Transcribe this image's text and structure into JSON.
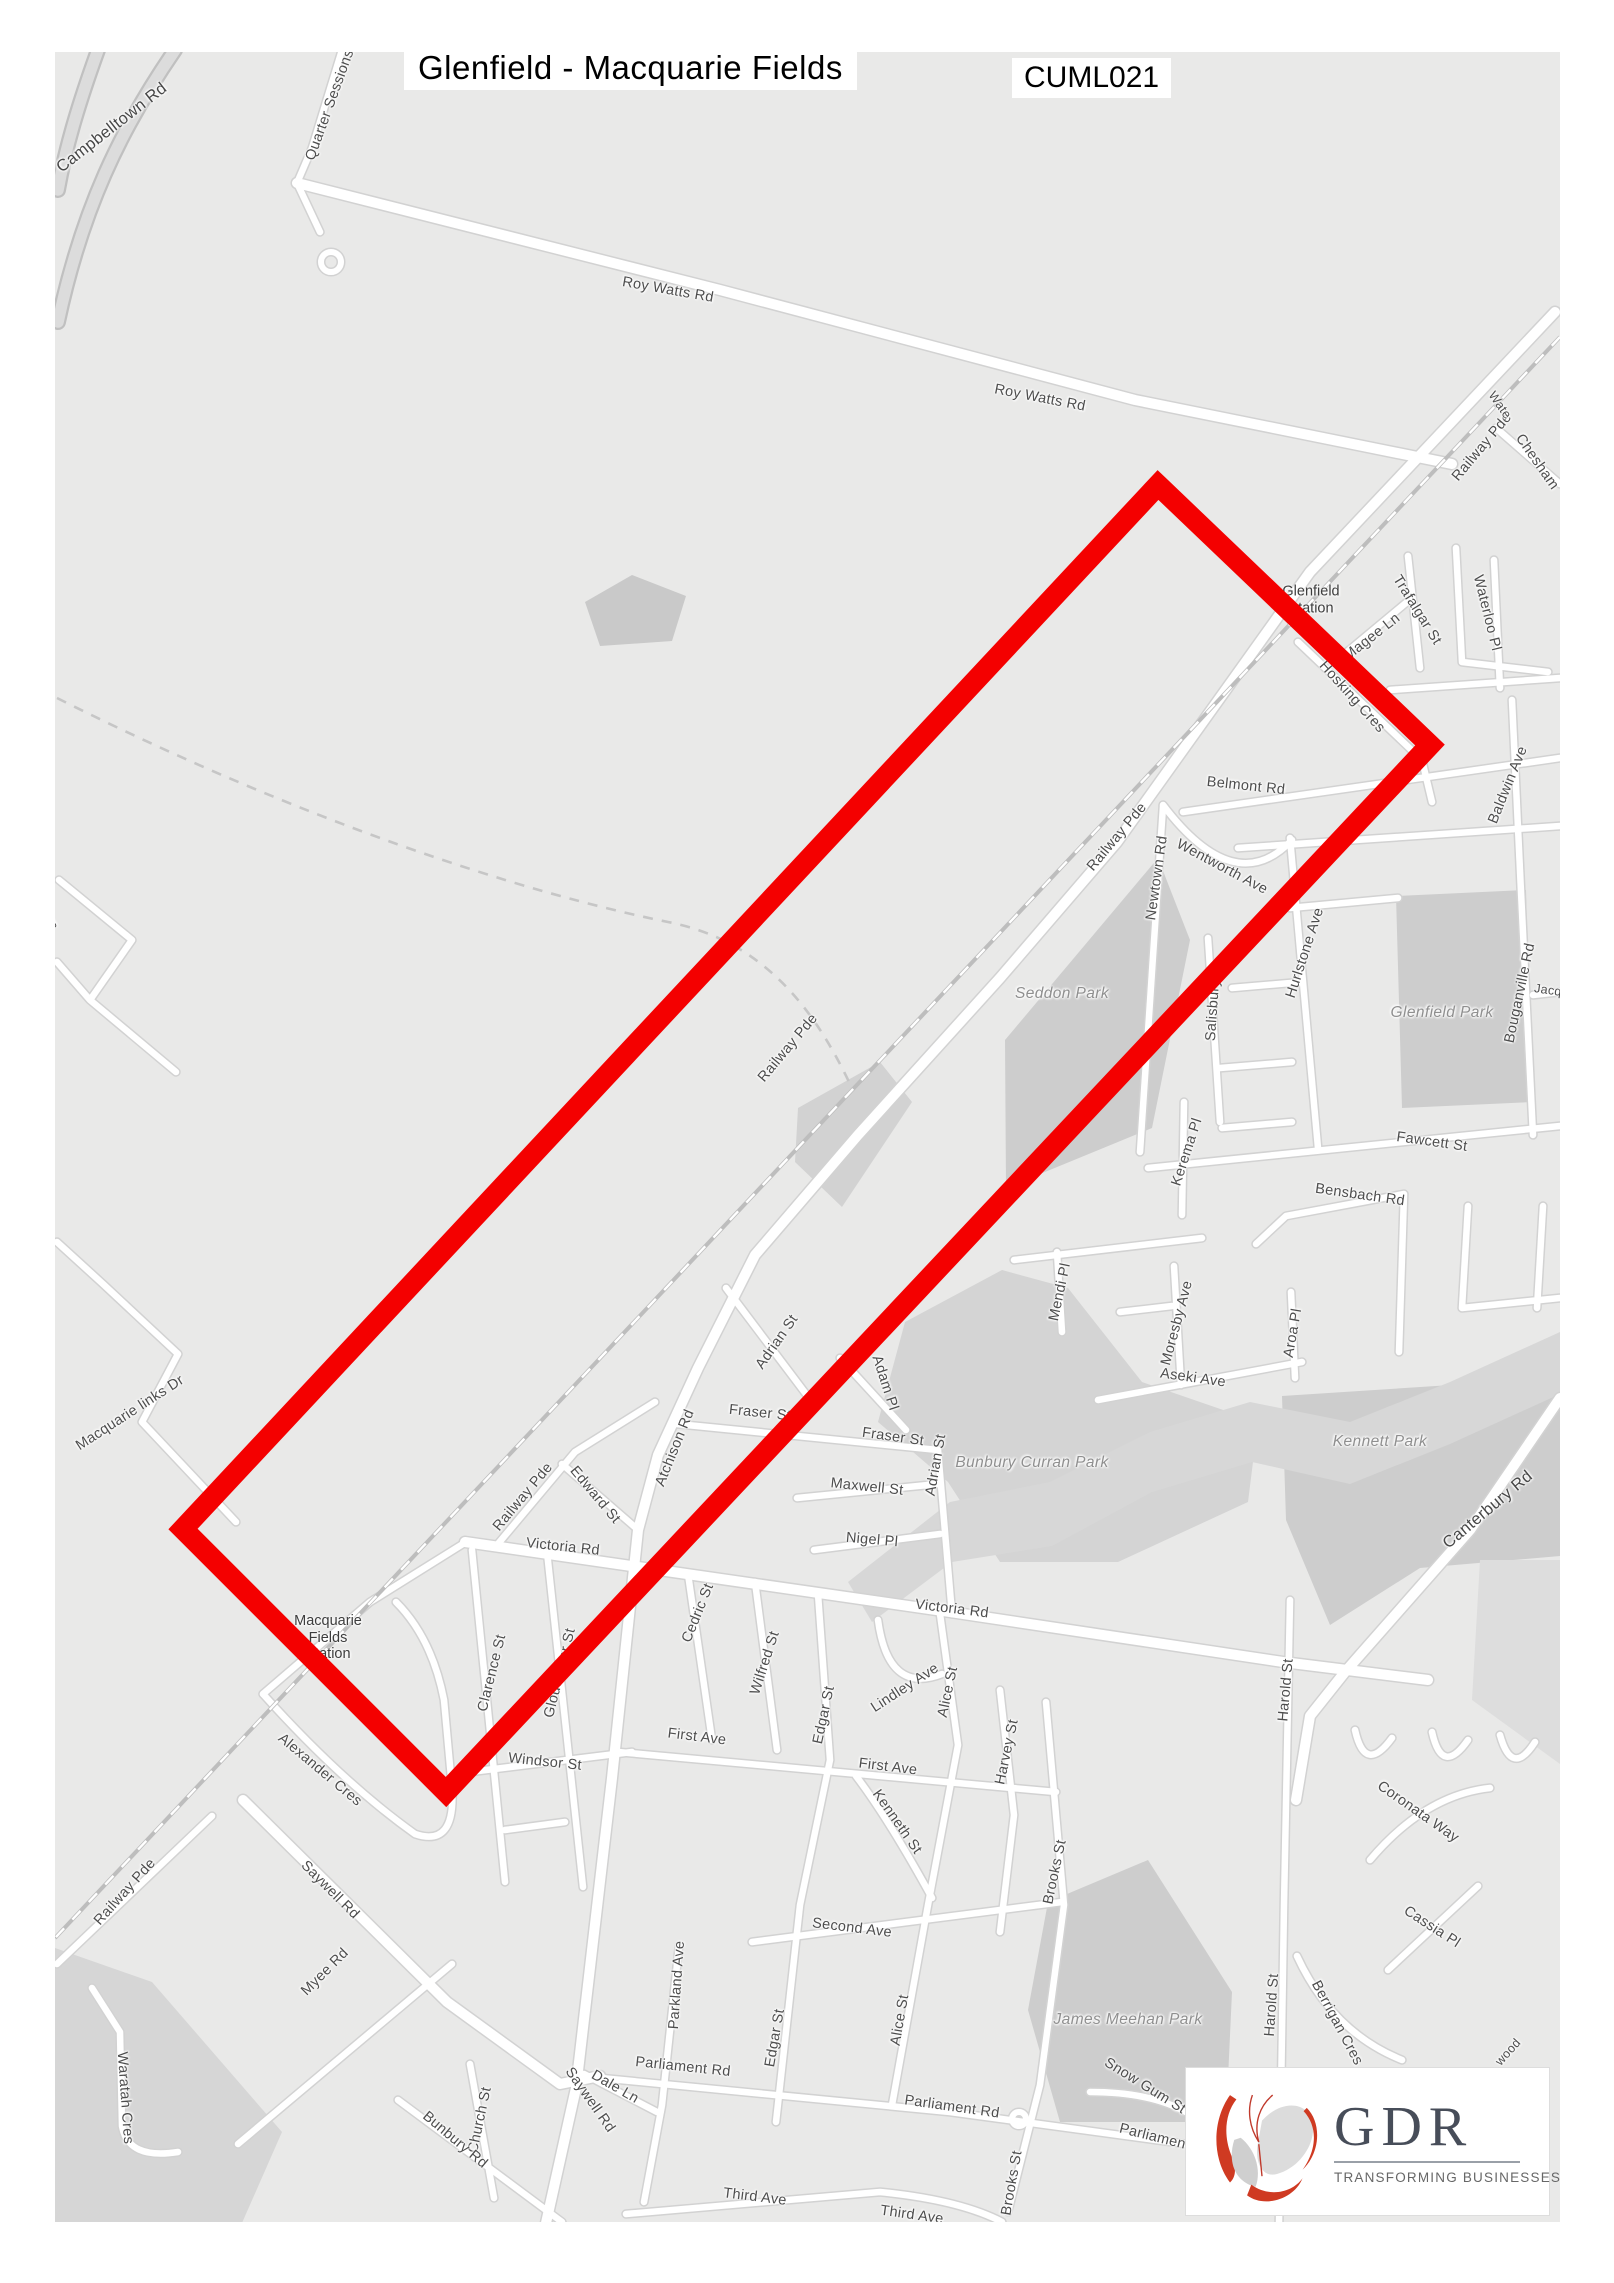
{
  "title": "Glenfield - Macquarie Fields",
  "code": "CUML021",
  "logo": {
    "name": "GDR",
    "tagline": "TRANSFORMING BUSINESSES"
  },
  "colors": {
    "bg": "#e9e9e8",
    "red": "#f40000",
    "roadFill": "#ffffff",
    "roadCasing": "#d2d2d2",
    "hwyFill": "#dcdcdc",
    "hwyCasing": "#c0c0c0",
    "park": "#cdcdcd",
    "rail": "#bdbdbd"
  },
  "stations": [
    {
      "lines": [
        "Glenfield",
        "Station"
      ],
      "x": 1311,
      "y": 600
    },
    {
      "lines": [
        "Macquarie",
        "Fields",
        "Station"
      ],
      "x": 328,
      "y": 1638
    }
  ],
  "labels": [
    {
      "t": "Campbelltown Rd",
      "x": 112,
      "y": 128,
      "r": -38,
      "c": "big"
    },
    {
      "t": "Quarter Sessions",
      "x": 330,
      "y": 105,
      "r": -70
    },
    {
      "t": "Roy Watts Rd",
      "x": 668,
      "y": 290,
      "r": 10
    },
    {
      "t": "Roy Watts Rd",
      "x": 1040,
      "y": 398,
      "r": 11
    },
    {
      "t": "Railway Pde",
      "x": 1482,
      "y": 447,
      "r": -50
    },
    {
      "t": "Chesham",
      "x": 1537,
      "y": 462,
      "r": 55
    },
    {
      "t": "Wate",
      "x": 1500,
      "y": 405,
      "r": 55,
      "c": "tiny"
    },
    {
      "t": "Waterloo Pl",
      "x": 1487,
      "y": 613,
      "r": 76
    },
    {
      "t": "Trafalgar St",
      "x": 1417,
      "y": 610,
      "r": 58
    },
    {
      "t": "Magee Ln",
      "x": 1372,
      "y": 637,
      "r": -38
    },
    {
      "t": "Hosking Cres",
      "x": 1352,
      "y": 697,
      "r": 48
    },
    {
      "t": "Belmont Rd",
      "x": 1246,
      "y": 786,
      "r": 6
    },
    {
      "t": "Baldwin Ave",
      "x": 1508,
      "y": 785,
      "r": -68
    },
    {
      "t": "Railway Pde",
      "x": 1117,
      "y": 837,
      "r": -50
    },
    {
      "t": "Newtown Rd",
      "x": 1157,
      "y": 878,
      "r": -82
    },
    {
      "t": "Wentworth Ave",
      "x": 1222,
      "y": 867,
      "r": 28
    },
    {
      "t": "Salisbury",
      "x": 1213,
      "y": 1010,
      "r": -86
    },
    {
      "t": "Hurlstone Ave",
      "x": 1305,
      "y": 953,
      "r": -72
    },
    {
      "t": "Seddon Park",
      "x": 1062,
      "y": 994,
      "r": 0,
      "c": "park"
    },
    {
      "t": "Glenfield Park",
      "x": 1442,
      "y": 1013,
      "r": 0,
      "c": "park"
    },
    {
      "t": "Bouganville Rd",
      "x": 1520,
      "y": 993,
      "r": -78
    },
    {
      "t": "Jacq",
      "x": 1548,
      "y": 990,
      "r": 8,
      "c": "tiny"
    },
    {
      "t": "Fawcett St",
      "x": 1432,
      "y": 1142,
      "r": 8
    },
    {
      "t": "Bensbach Rd",
      "x": 1360,
      "y": 1195,
      "r": 8
    },
    {
      "t": "Kerema Pl",
      "x": 1187,
      "y": 1152,
      "r": -72
    },
    {
      "t": "Mendi Pl",
      "x": 1060,
      "y": 1292,
      "r": -78
    },
    {
      "t": "Moresby Ave",
      "x": 1177,
      "y": 1323,
      "r": -75
    },
    {
      "t": "Aroa Pl",
      "x": 1293,
      "y": 1333,
      "r": -80
    },
    {
      "t": "Aseki Ave",
      "x": 1193,
      "y": 1378,
      "r": 8
    },
    {
      "t": "Kennett Park",
      "x": 1380,
      "y": 1442,
      "r": 0,
      "c": "park"
    },
    {
      "t": "Canterbury Rd",
      "x": 1488,
      "y": 1510,
      "r": -40,
      "c": "big"
    },
    {
      "t": "Railway Pde",
      "x": 788,
      "y": 1048,
      "r": -50
    },
    {
      "t": "Macquarie links Dr",
      "x": 130,
      "y": 1413,
      "r": -33
    },
    {
      "t": "way",
      "x": 47,
      "y": 928,
      "r": -55,
      "c": "tiny"
    },
    {
      "t": "Adrian St",
      "x": 777,
      "y": 1342,
      "r": -55
    },
    {
      "t": "Adam Pl",
      "x": 885,
      "y": 1383,
      "r": 72
    },
    {
      "t": "Fraser St",
      "x": 760,
      "y": 1413,
      "r": 6
    },
    {
      "t": "Fraser St",
      "x": 893,
      "y": 1437,
      "r": 8
    },
    {
      "t": "Adrian St",
      "x": 936,
      "y": 1465,
      "r": -80
    },
    {
      "t": "Atchison Rd",
      "x": 675,
      "y": 1448,
      "r": -68
    },
    {
      "t": "Maxwell St",
      "x": 867,
      "y": 1487,
      "r": 6
    },
    {
      "t": "Nigel Pl",
      "x": 872,
      "y": 1540,
      "r": 5
    },
    {
      "t": "Bunbury Curran Park",
      "x": 1032,
      "y": 1463,
      "r": 0,
      "c": "park"
    },
    {
      "t": "Railway Pde",
      "x": 523,
      "y": 1497,
      "r": -50
    },
    {
      "t": "Edward St",
      "x": 595,
      "y": 1495,
      "r": 50
    },
    {
      "t": "Victoria Rd",
      "x": 563,
      "y": 1547,
      "r": 6
    },
    {
      "t": "Victoria Rd",
      "x": 952,
      "y": 1609,
      "r": 7
    },
    {
      "t": "Harold St",
      "x": 1286,
      "y": 1690,
      "r": -85
    },
    {
      "t": "Cedric St",
      "x": 698,
      "y": 1613,
      "r": -68
    },
    {
      "t": "Wilfred St",
      "x": 765,
      "y": 1663,
      "r": -72
    },
    {
      "t": "Edgar St",
      "x": 824,
      "y": 1715,
      "r": -78
    },
    {
      "t": "Lindley Ave",
      "x": 905,
      "y": 1688,
      "r": -33
    },
    {
      "t": "Alice St",
      "x": 948,
      "y": 1692,
      "r": -78
    },
    {
      "t": "Harvey St",
      "x": 1007,
      "y": 1752,
      "r": -78
    },
    {
      "t": "First Ave",
      "x": 697,
      "y": 1737,
      "r": 7
    },
    {
      "t": "First Ave",
      "x": 888,
      "y": 1767,
      "r": 7
    },
    {
      "t": "Kenneth St",
      "x": 897,
      "y": 1822,
      "r": 55
    },
    {
      "t": "Clarence St",
      "x": 492,
      "y": 1673,
      "r": -76
    },
    {
      "t": "Gloucester St",
      "x": 560,
      "y": 1673,
      "r": -76
    },
    {
      "t": "Windsor St",
      "x": 545,
      "y": 1762,
      "r": 6
    },
    {
      "t": "Alexander Cres",
      "x": 320,
      "y": 1770,
      "r": 40
    },
    {
      "t": "Coronata Way",
      "x": 1418,
      "y": 1812,
      "r": 35
    },
    {
      "t": "Brooks St",
      "x": 1055,
      "y": 1872,
      "r": -78
    },
    {
      "t": "Saywell Rd",
      "x": 330,
      "y": 1890,
      "r": 45
    },
    {
      "t": "Railway Pde",
      "x": 125,
      "y": 1892,
      "r": -48
    },
    {
      "t": "Myee Rd",
      "x": 325,
      "y": 1972,
      "r": -45
    },
    {
      "t": "Second Ave",
      "x": 852,
      "y": 1928,
      "r": 7
    },
    {
      "t": "Parkland Ave",
      "x": 677,
      "y": 1985,
      "r": -86
    },
    {
      "t": "Edgar St",
      "x": 775,
      "y": 2038,
      "r": -80
    },
    {
      "t": "Alice St",
      "x": 900,
      "y": 2020,
      "r": -80
    },
    {
      "t": "James Meehan Park",
      "x": 1128,
      "y": 2020,
      "r": 0,
      "c": "park"
    },
    {
      "t": "Cassia Pl",
      "x": 1432,
      "y": 1927,
      "r": 33
    },
    {
      "t": "Berrigan Cres",
      "x": 1337,
      "y": 2023,
      "r": 62
    },
    {
      "t": "wood",
      "x": 1508,
      "y": 2052,
      "r": -48,
      "c": "tiny"
    },
    {
      "t": "Harold St",
      "x": 1272,
      "y": 2005,
      "r": -86
    },
    {
      "t": "Waratah Cres",
      "x": 125,
      "y": 2098,
      "r": 86
    },
    {
      "t": "Dale Ln",
      "x": 615,
      "y": 2087,
      "r": 30
    },
    {
      "t": "Parliament Rd",
      "x": 683,
      "y": 2067,
      "r": 6
    },
    {
      "t": "Parliament Rd",
      "x": 952,
      "y": 2107,
      "r": 8
    },
    {
      "t": "Saywell Rd",
      "x": 590,
      "y": 2100,
      "r": 55
    },
    {
      "t": "Church St",
      "x": 480,
      "y": 2120,
      "r": -78
    },
    {
      "t": "Bunbury Rd",
      "x": 455,
      "y": 2140,
      "r": 40
    },
    {
      "t": "Snow Gum St",
      "x": 1145,
      "y": 2086,
      "r": 32
    },
    {
      "t": "Parliament Rd",
      "x": 1166,
      "y": 2140,
      "r": 14
    },
    {
      "t": "Third Ave",
      "x": 755,
      "y": 2197,
      "r": 7
    },
    {
      "t": "Third Ave",
      "x": 912,
      "y": 2215,
      "r": 8
    },
    {
      "t": "Brooks St",
      "x": 1012,
      "y": 2183,
      "r": -80
    }
  ],
  "map": {
    "red": {
      "points": "1158,485 1430,745 446,1792 183,1529",
      "width": 21
    },
    "railway": {
      "main": "M 1560,337 L 55,1938",
      "branch": "M 57,698 C 300,820 520,892 668,922 C 760,940 812,1004 850,1084"
    },
    "circles": [
      {
        "x": 331,
        "y": 262,
        "r": 10
      },
      {
        "x": 1019,
        "y": 2119,
        "r": 7
      }
    ],
    "parks": [
      {
        "p": "1005,1040 1158,858 1190,940 1152,1128 1006,1188"
      },
      {
        "p": "1396,896 1526,890 1532,1102 1402,1108"
      },
      {
        "p": "1282,1396 1560,1378 1560,1556 1420,1568 1330,1625 1286,1520"
      },
      {
        "p": "1048,1902 1148,1860 1232,1992 1226,2122 1060,2122 1028,2010"
      },
      {
        "p": "905,1322 1002,1270 1068,1288 1142,1382 1258,1422 1248,1502 1118,1562 1000,1562 948,1482 878,1422",
        "f": "#d4d4d4"
      },
      {
        "p": "848,1582 950,1502 1050,1482 1150,1432 1250,1402 1350,1422 1450,1382 1560,1332 1560,1394 1450,1444 1350,1484 1252,1462 1152,1492 1052,1546 952,1562 872,1622",
        "f": "#d7d7d7"
      },
      {
        "p": "55,1948 152,1982 282,2132 242,2223 55,2223",
        "f": "#d6d6d6"
      },
      {
        "p": "585,602 632,575 686,596 672,641 600,646",
        "f": "#c9c9c9"
      },
      {
        "p": "798,1108 880,1062 912,1102 842,1207 795,1162",
        "f": "#d2d2d2"
      },
      {
        "p": "1480,1560 1560,1560 1560,1764 1472,1700",
        "f": "#dddddd"
      }
    ],
    "roads": [
      {
        "w": "h",
        "d": "M 175,50 C 120,130 82,210 58,322 M 98,50 C 80,100 66,145 58,190"
      },
      {
        "w": "m",
        "d": "M 342,50 L 312,148 L 297,183 L 320,232"
      },
      {
        "w": "M",
        "d": "M 297,183 L 720,290 L 1135,400 L 1452,464"
      },
      {
        "w": "M",
        "d": "M 1555,312 L 1310,572 L 1117,842 L 1000,978 L 858,1135 L 755,1255 L 698,1368 L 658,1455 L 638,1530 L 612,1778 L 576,2088 L 546,2223"
      },
      {
        "w": "m",
        "d": "M 1496,428 L 1560,484"
      },
      {
        "w": "m",
        "d": "M 1456,548 L 1462,662 L 1548,672"
      },
      {
        "w": "m",
        "d": "M 1408,556 L 1420,668 M 1390,690 L 1560,678 M 1494,560 L 1500,688"
      },
      {
        "w": "m",
        "d": "M 1341,657 L 1407,602"
      },
      {
        "w": "m",
        "d": "M 1298,642 L 1422,760 L 1432,802"
      },
      {
        "w": "m",
        "d": "M 1183,812 L 1560,758"
      },
      {
        "w": "m",
        "d": "M 1512,700 L 1521,892 L 1533,1135"
      },
      {
        "w": "m",
        "d": "M 1533,995 L 1560,992"
      },
      {
        "w": "m",
        "d": "M 1238,848 L 1560,826 M 1290,908 L 1398,898"
      },
      {
        "w": "m",
        "d": "M 1163,805 Q 1235,900 1292,840"
      },
      {
        "w": "m",
        "d": "M 1163,806 L 1140,1152"
      },
      {
        "w": "m",
        "d": "M 1208,938 L 1220,1122"
      },
      {
        "w": "m",
        "d": "M 1290,838 L 1318,1148"
      },
      {
        "w": "m",
        "d": "M 1232,988 L 1302,982 M 1220,1068 L 1292,1062 M 1222,1128 L 1292,1122"
      },
      {
        "w": "m",
        "d": "M 1184,1102 L 1182,1215"
      },
      {
        "w": "m",
        "d": "M 1148,1168 L 1560,1126"
      },
      {
        "w": "m",
        "d": "M 1286,1216 L 1404,1194 L 1399,1352 M 1286,1216 L 1256,1244"
      },
      {
        "w": "m",
        "d": "M 1468,1206 L 1462,1308 M 1543,1206 L 1537,1308 M 1462,1308 L 1560,1298"
      },
      {
        "w": "m",
        "d": "M 1057,1252 L 1062,1332"
      },
      {
        "w": "m",
        "d": "M 1014,1260 L 1202,1238"
      },
      {
        "w": "m",
        "d": "M 1174,1266 L 1181,1385 M 1120,1312 L 1172,1306"
      },
      {
        "w": "m",
        "d": "M 1098,1400 L 1302,1362 M 1291,1292 L 1295,1378"
      },
      {
        "w": "m",
        "d": "M 677,1424 L 938,1450 M 840,1358 L 906,1430"
      },
      {
        "w": "m",
        "d": "M 726,1288 L 812,1402"
      },
      {
        "w": "m",
        "d": "M 938,1450 L 952,1614"
      },
      {
        "w": "m",
        "d": "M 797,1498 L 938,1484 M 814,1550 L 940,1534"
      },
      {
        "w": "M",
        "d": "M 465,1542 L 950,1612 L 1283,1662 L 1428,1680"
      },
      {
        "w": "m",
        "d": "M 497,1545 L 575,1452 L 655,1402 M 562,1464 L 636,1528"
      },
      {
        "w": "m",
        "d": "M 472,1550 L 505,1882 M 505,1830 L 565,1822"
      },
      {
        "w": "m",
        "d": "M 547,1552 L 583,1887"
      },
      {
        "w": "m",
        "d": "M 470,1772 L 632,1752"
      },
      {
        "w": "m",
        "d": "M 688,1574 L 712,1740"
      },
      {
        "w": "m",
        "d": "M 755,1582 L 777,1750"
      },
      {
        "w": "m",
        "d": "M 818,1594 L 830,1760 L 800,1905 L 776,2122"
      },
      {
        "w": "m",
        "d": "M 878,1620 Q 888,1695 942,1674"
      },
      {
        "w": "m",
        "d": "M 940,1614 L 958,1745 L 928,1905 L 892,2105"
      },
      {
        "w": "m",
        "d": "M 1000,1690 L 1014,1815 L 1000,1932"
      },
      {
        "w": "m",
        "d": "M 1046,1702 L 1064,1905 L 1040,2085 L 1008,2212"
      },
      {
        "w": "m",
        "d": "M 618,1752 L 1056,1792"
      },
      {
        "w": "m",
        "d": "M 856,1776 Q 888,1818 932,1898"
      },
      {
        "w": "m",
        "d": "M 752,1942 L 1062,1902"
      },
      {
        "w": "m",
        "d": "M 626,2214 L 880,2192 Q 960,2200 1002,2222"
      },
      {
        "w": "m",
        "d": "M 580,2076 L 950,2112 L 1186,2144"
      },
      {
        "w": "m",
        "d": "M 584,2074 L 657,2112"
      },
      {
        "w": "m",
        "d": "M 679,1946 L 662,2105 L 644,2202"
      },
      {
        "w": "M",
        "d": "M 243,1800 L 447,2002 L 560,2084 L 600,2076"
      },
      {
        "w": "m",
        "d": "M 238,2144 L 452,1964"
      },
      {
        "w": "m",
        "d": "M 92,1988 L 120,2032 L 122,2126 Q 128,2160 178,2152"
      },
      {
        "w": "m",
        "d": "M 212,1816 L 57,1964"
      },
      {
        "w": "m",
        "d": "M 263,1694 Q 342,1782 415,1834 Q 456,1848 452,1788 L 444,1700 Q 432,1638 396,1602"
      },
      {
        "w": "m",
        "d": "M 370,1602 L 466,1542 M 263,1694 L 370,1602"
      },
      {
        "w": "m",
        "d": "M 398,2100 L 562,2222 M 470,2064 L 494,2198"
      },
      {
        "w": "m",
        "d": "M 1090,2092 Q 1150,2092 1186,2112"
      },
      {
        "w": "m",
        "d": "M 1297,1956 Q 1332,2032 1402,2060"
      },
      {
        "w": "m",
        "d": "M 1388,1970 L 1478,1886"
      },
      {
        "w": "M",
        "d": "M 1560,1398 L 1470,1530 L 1345,1672 L 1310,1716 L 1296,1800"
      },
      {
        "w": "m",
        "d": "M 1290,1600 L 1284,1905 L 1279,2223"
      },
      {
        "w": "m",
        "d": "M 1370,1860 Q 1425,1795 1490,1788 M 1355,1730 Q 1365,1775 1392,1738 M 1432,1732 Q 1442,1777 1468,1740 M 1500,1735 Q 1512,1778 1535,1742"
      },
      {
        "w": "m",
        "d": "M 59,880 L 132,940 L 90,1000 L 176,1072 M 57,962 L 90,1000"
      },
      {
        "w": "m",
        "d": "M 103,1284 L 178,1354 L 142,1422 L 236,1522 M 57,1242 L 103,1284"
      }
    ]
  }
}
